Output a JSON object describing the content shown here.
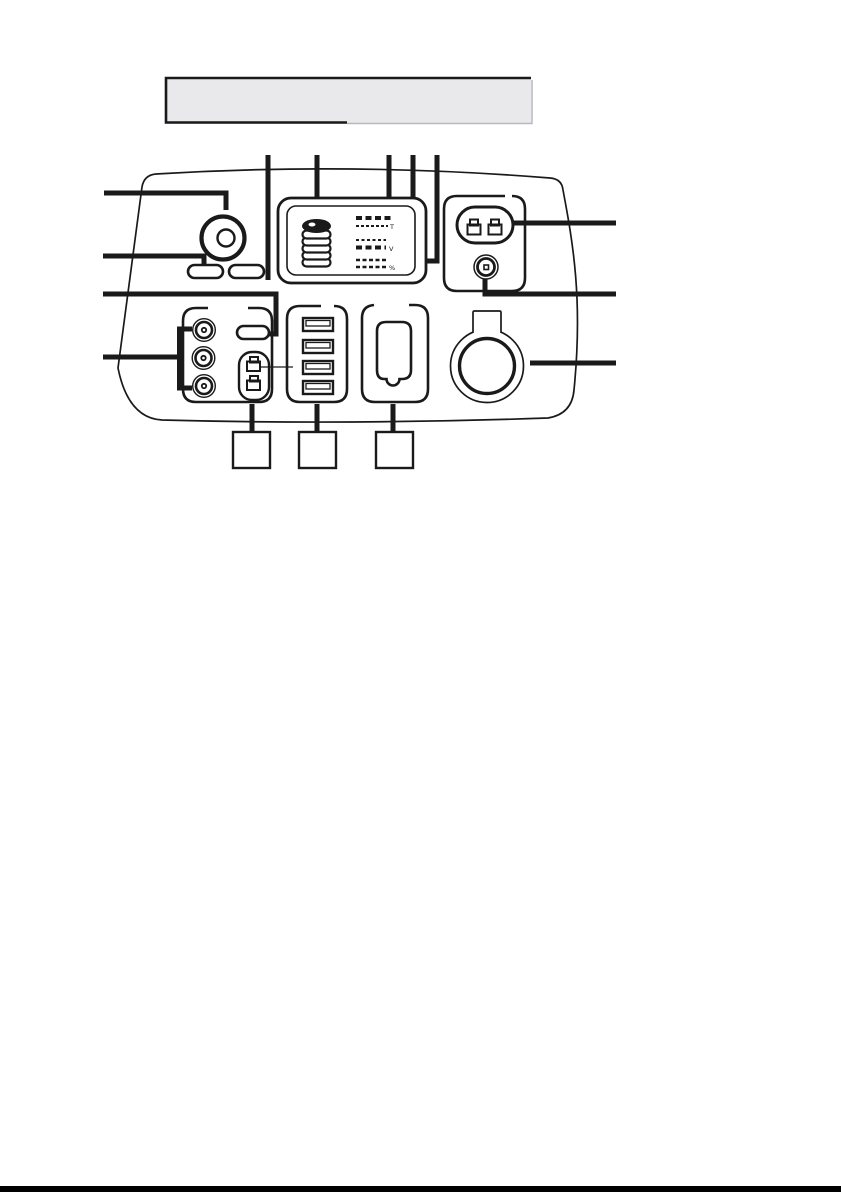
{
  "colors": {
    "ink": "#1a1a1a",
    "paper": "#ffffff",
    "title_box_fill": "#e9e9eb",
    "title_box_shadow": "#b9b9bd"
  },
  "title_box": {
    "text": ""
  },
  "device_panel": {
    "display": {
      "battery_icon": "battery-level-stack-icon",
      "rows": [
        {
          "unit": "T"
        },
        {
          "unit": "V"
        },
        {
          "unit": "%"
        }
      ]
    },
    "controls": {
      "dial": "rotary-knob",
      "button_count": 2
    },
    "ac_section": {
      "outlet": "two-prong-ac-outlet",
      "dc_input": "dc-input-jack"
    },
    "dc_section": {
      "barrel_jack_count": 3,
      "pill_slot": "flat-slot",
      "connector_pair_count": 2
    },
    "usb_section": {
      "port_count": 4
    },
    "accessory_port": "covered-port-with-notch",
    "car_socket": "12v-car-socket"
  },
  "callouts": {
    "left_count": 4,
    "top_count": 5,
    "right_count": 3,
    "bottom_boxes": [
      "",
      "",
      ""
    ]
  }
}
